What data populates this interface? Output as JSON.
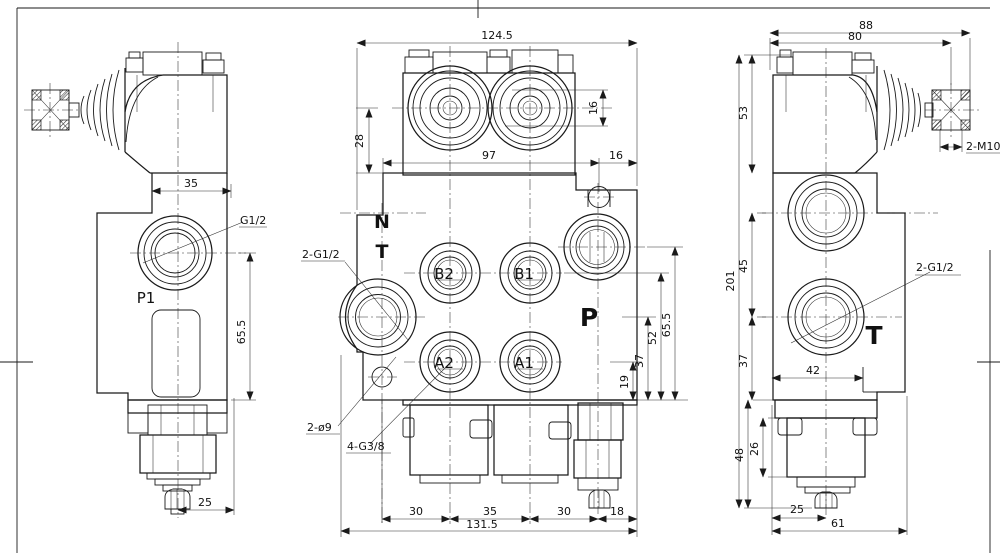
{
  "sheet": {
    "background": "#ffffff",
    "line_color": "#1a1a1a",
    "type": "hydraulic directional control valve - 2 spool monoblock, 3-view engineering drawing"
  },
  "views": {
    "side_left": {
      "labels": {
        "dim_35": "35",
        "g12": "G1/2",
        "p1": "P1",
        "dim_65_5": "65.5",
        "dim_25": "25"
      }
    },
    "front": {
      "labels": {
        "dim_124_5": "124.5",
        "dim_28": "28",
        "dim_16_spool": "16",
        "dim_97": "97",
        "dim_16_edge": "16",
        "n": "N",
        "t": "T",
        "leader_2g12": "2-G1/2",
        "b2": "B2",
        "b1": "B1",
        "a2": "A2",
        "a1": "A1",
        "p": "P",
        "leader_2o9": "2-ø9",
        "leader_4g38": "4-G3/8",
        "dim_19": "19",
        "dim_37": "37",
        "dim_52": "52",
        "dim_65_5": "65.5",
        "dim_30_left": "30",
        "dim_35": "35",
        "dim_30_right": "30",
        "dim_18": "18",
        "dim_131_5": "131.5"
      }
    },
    "side_right": {
      "labels": {
        "dim_88": "88",
        "dim_80": "80",
        "dim_53": "53",
        "m10": "2-M10",
        "dim_201": "201",
        "dim_45": "45",
        "leader_2g12": "2-G1/2",
        "t": "T",
        "dim_37": "37",
        "dim_42": "42",
        "dim_48": "48",
        "dim_26": "26",
        "dim_25": "25",
        "dim_61": "61"
      }
    }
  }
}
